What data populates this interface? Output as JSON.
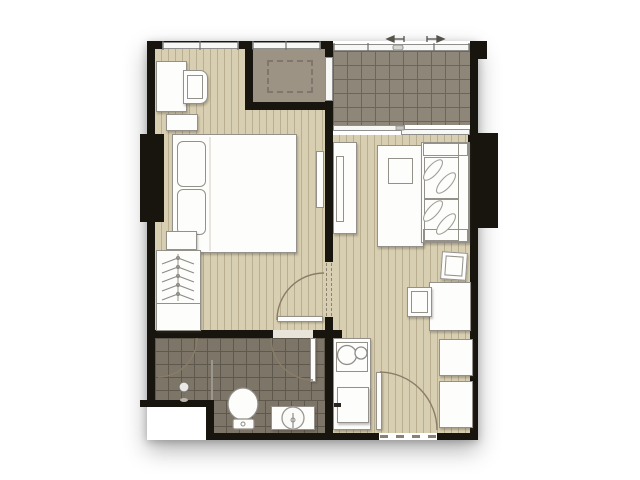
{
  "document": {
    "kind": "apartment-floor-plan",
    "style": "top-down architectural rendering, no text labels",
    "rooms": [
      "bedroom",
      "built-in-closet",
      "balcony",
      "living-room",
      "kitchen",
      "bathroom",
      "entrance"
    ]
  },
  "rooms": {
    "bedroom": {
      "floor": "wood-plank",
      "furniture": [
        "desk",
        "desk-chair",
        "nightstand-top",
        "double-bed",
        "two-pillows",
        "nightstand-bottom",
        "wardrobe-with-hangers",
        "wall-tv"
      ]
    },
    "built_in_closet": {
      "floor": "dark-taupe",
      "features": [
        "dashed-storage-outline",
        "window-to-balcony"
      ]
    },
    "balcony": {
      "floor": "tile-grid",
      "features": [
        "railing-with-slide-arrows",
        "sliding-glass-door"
      ]
    },
    "living_room": {
      "floor": "wood-plank",
      "furniture": [
        "tv-cabinet",
        "tv",
        "side-table-with-tray",
        "sofa-with-leaf-pillows",
        "dining-chair-top",
        "dining-table",
        "dining-chair-left",
        "cabinet-a",
        "cabinet-b"
      ]
    },
    "kitchen": {
      "floor": "wood-plank",
      "furniture": [
        "counter-with-sink-and-hob",
        "refrigerator"
      ]
    },
    "bathroom": {
      "floor": "dark-tile-grid",
      "furniture": [
        "shower-head",
        "shower-glass-partition",
        "shower-door",
        "toilet",
        "vanity-with-round-basin"
      ]
    },
    "entrance": {
      "features": [
        "entry-door-swing",
        "dashed-threshold"
      ]
    }
  },
  "doors": [
    "bedroom-door",
    "bathroom-door",
    "shower-door",
    "entrance-door"
  ],
  "windows": [
    "bedroom-window",
    "closet-window",
    "closet-side-window",
    "balcony-railing",
    "balcony-sliding-door"
  ],
  "colors": {
    "wall": "#18150f",
    "floorwood": "#d8cfb2",
    "plank": "#b9ae8f",
    "closet": "#9c9385",
    "closetdash": "#7f776b",
    "balconytile": "#8e8678",
    "balconygrid": "#6c665a",
    "bathtile": "#7c7568",
    "bathgrid": "#5f594d",
    "furnfill": "#fdfdfc",
    "furnline": "#94918a",
    "glass": "#f7f7f5",
    "frame": "#8e8e8c",
    "arc": "#8a7d68",
    "dash": "#8a8173",
    "threshold": "#e8e4da"
  }
}
